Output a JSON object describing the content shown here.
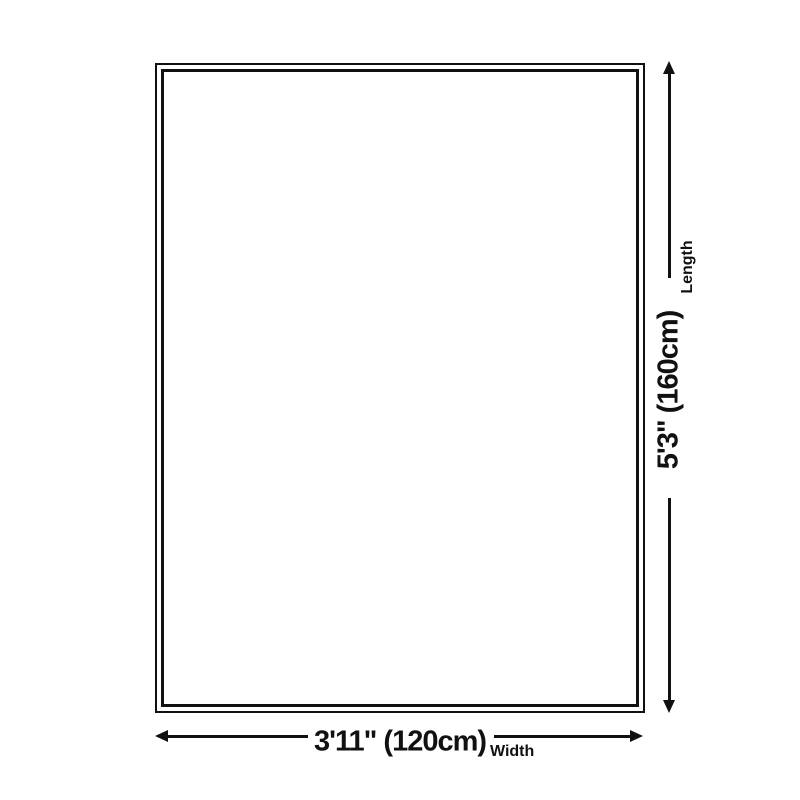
{
  "colors": {
    "background": "#ffffff",
    "ink": "#111111"
  },
  "dimensions": {
    "length": {
      "value": "5'3\" (160cm)",
      "label": "Length"
    },
    "width": {
      "value": "3'11\" (120cm)",
      "label": "Width"
    }
  },
  "icons": {
    "arrow_up": "css-triangle-up",
    "arrow_down": "css-triangle-down",
    "arrow_left": "css-triangle-left",
    "arrow_right": "css-triangle-right"
  }
}
